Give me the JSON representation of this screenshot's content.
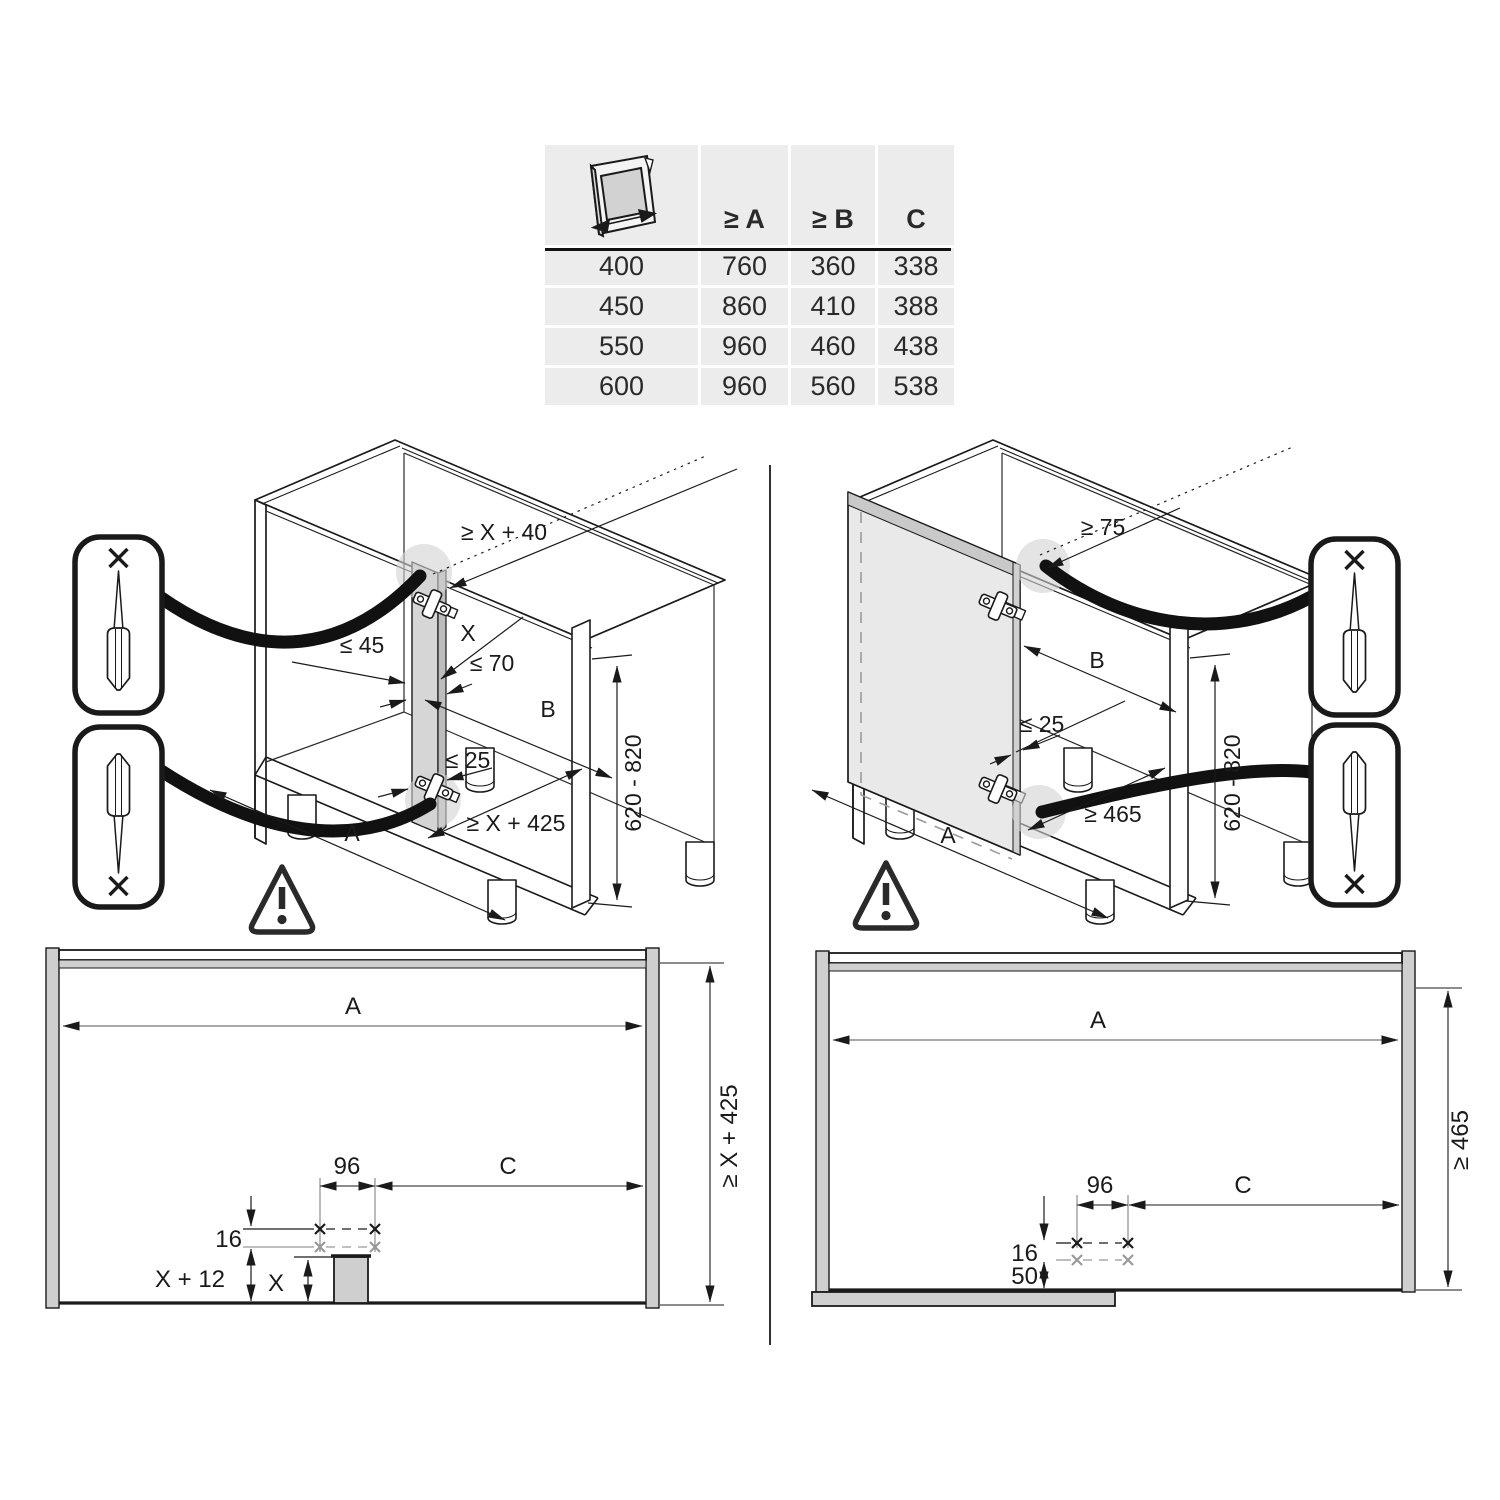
{
  "table": {
    "icon": "door-width-icon",
    "headers": [
      "≥ A",
      "≥ B",
      "C"
    ],
    "rows": [
      [
        "400",
        "760",
        "360",
        "338"
      ],
      [
        "450",
        "860",
        "410",
        "388"
      ],
      [
        "550",
        "960",
        "460",
        "438"
      ],
      [
        "600",
        "960",
        "560",
        "538"
      ]
    ]
  },
  "iso_left": {
    "dim_top": "≥ X + 40",
    "dim_x": "X",
    "dim_70": "≤ 70",
    "dim_45": "≤ 45",
    "dim_b": "B",
    "dim_25": "≤ 25",
    "dim_depth": "≥ X + 425",
    "dim_a": "A",
    "dim_height": "620 - 820"
  },
  "iso_right": {
    "dim_top": "≥ 75",
    "dim_b": "B",
    "dim_25": "≤ 25",
    "dim_depth": "≥ 465",
    "dim_a": "A",
    "dim_height": "620 - 820"
  },
  "elev_left": {
    "dim_a": "A",
    "dim_height": "≥ X + 425",
    "dim_96": "96",
    "dim_c": "C",
    "dim_16": "16",
    "dim_x12": "X + 12",
    "dim_x": "X"
  },
  "elev_right": {
    "dim_a": "A",
    "dim_height": "≥ 465",
    "dim_96": "96",
    "dim_c": "C",
    "dim_16": "16",
    "dim_50": "50"
  },
  "colors": {
    "line": "#1a1a1a",
    "panel_gray": "#d5d5d5",
    "table_bg": "#ececec",
    "shade_circle": "#d2d2d2"
  }
}
